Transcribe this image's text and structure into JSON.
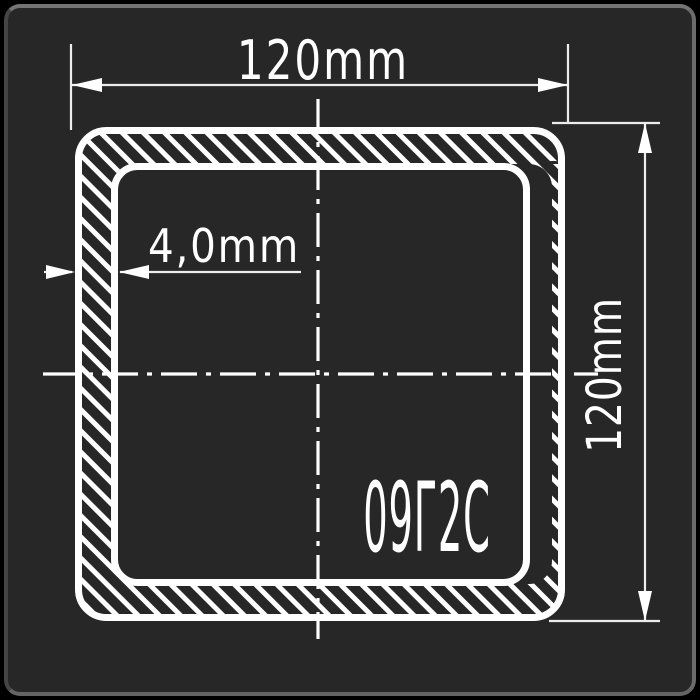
{
  "drawing": {
    "name": "square-tube-cross-section",
    "width_label": "120mm",
    "height_label": "120mm",
    "thickness_label": "4,0mm",
    "grade_label": "09Г2С"
  },
  "colors": {
    "page_background": "#000000",
    "card_background": "#272727",
    "card_border": "#6b6b6b",
    "line": "#ffffff",
    "dimension_line": "#ededed"
  }
}
